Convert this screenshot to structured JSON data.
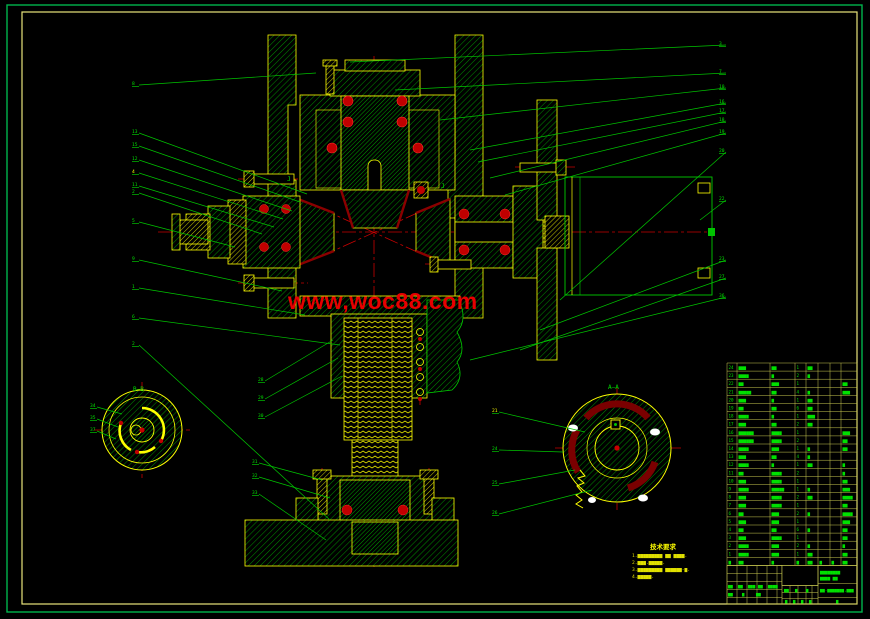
{
  "watermark": {
    "text": "www,woc88.com",
    "color": "#e60000"
  },
  "section_labels": {
    "left_circle": "B—B",
    "right_circle": "A—A",
    "detail_j1": "J",
    "detail_j2": "J"
  },
  "leaders": {
    "left": [
      "8",
      "13",
      "15",
      "12",
      "4",
      "11",
      "2",
      "5",
      "9",
      "1",
      "6",
      "2"
    ],
    "right": [
      "3",
      "7",
      "10",
      "16",
      "17",
      "18",
      "19",
      "20",
      "22",
      "23",
      "27",
      "36"
    ],
    "worm": [
      "28",
      "29",
      "30"
    ],
    "mid": [
      "31",
      "32",
      "33"
    ],
    "circle_left": [
      "34",
      "35",
      "37"
    ],
    "circle_right": [
      "21",
      "24",
      "25",
      "26"
    ]
  },
  "notes": {
    "title": "技术要求",
    "lines": [
      "1.▆▆▆▆▆▆▆▆▆ ▆▆ ▆▆▆▆.",
      "2.▆▆▆.▆▆▆▆▆.",
      "3.▆▆▆▆▆▆▆▆▆ ▆▆▆▆▆▆-▆.",
      "4.▆▆▆▆▆."
    ]
  },
  "parts_table": {
    "rows": [
      [
        "24",
        "▆▆▆",
        "▆▆",
        "1",
        "▆▆",
        "",
        "",
        ""
      ],
      [
        "23",
        "▆▆▆▆",
        "▆",
        "2",
        "▆",
        "",
        "",
        ""
      ],
      [
        "22",
        "▆▆",
        "▆▆▆",
        "1",
        "",
        "",
        "",
        "▆▆"
      ],
      [
        "21",
        "▆▆▆▆▆",
        "▆▆",
        "4",
        "▆",
        "",
        "",
        "▆▆▆"
      ],
      [
        "20",
        "▆▆▆",
        "▆",
        "1",
        "▆▆",
        "",
        "",
        ""
      ],
      [
        "19",
        "▆▆",
        "▆▆",
        "6",
        "▆▆",
        "",
        "",
        ""
      ],
      [
        "18",
        "▆▆▆▆",
        "▆",
        "1",
        "▆▆▆",
        "",
        "",
        ""
      ],
      [
        "17",
        "▆▆▆",
        "▆▆",
        "2",
        "▆▆",
        "",
        "",
        ""
      ],
      [
        "16",
        "▆▆▆▆▆▆",
        "▆▆▆▆",
        "1",
        "",
        "",
        "",
        "▆▆▆"
      ],
      [
        "15",
        "▆▆▆▆▆▆",
        "▆▆▆▆",
        "2",
        "",
        "",
        "",
        "▆▆"
      ],
      [
        "14",
        "▆▆▆▆",
        "▆▆▆",
        "1",
        "▆",
        "",
        "",
        "▆▆"
      ],
      [
        "13",
        "▆▆▆",
        "▆▆",
        "4",
        "▆",
        "",
        "",
        ""
      ],
      [
        "12",
        "▆▆▆▆",
        "▆",
        "1",
        "▆▆",
        "",
        "",
        "▆"
      ],
      [
        "11",
        "▆▆",
        "▆▆▆▆",
        "2",
        "",
        "",
        "",
        "▆"
      ],
      [
        "10",
        "▆▆▆",
        "▆▆▆▆",
        "1",
        "",
        "",
        "",
        "▆▆"
      ],
      [
        "9",
        "▆▆▆▆",
        "▆▆▆▆▆",
        "1",
        "▆",
        "",
        "",
        "▆▆▆"
      ],
      [
        "8",
        "▆▆▆",
        "▆▆▆▆",
        "2",
        "▆▆",
        "",
        "",
        "▆▆▆▆"
      ],
      [
        "7",
        "▆▆▆",
        "▆▆▆▆",
        "1",
        "",
        "",
        "",
        "▆▆"
      ],
      [
        "6",
        "▆▆",
        "▆▆▆",
        "2",
        "▆",
        "",
        "",
        "▆▆▆▆"
      ],
      [
        "5",
        "▆▆▆",
        "▆▆▆",
        "1",
        "",
        "",
        "",
        "▆▆▆"
      ],
      [
        "4",
        "▆▆",
        "▆▆",
        "6",
        "▆",
        "",
        "",
        "▆▆"
      ],
      [
        "3",
        "▆▆▆",
        "▆▆▆▆",
        "1",
        "",
        "",
        "",
        "▆▆"
      ],
      [
        "2",
        "▆▆▆▆",
        "▆▆▆",
        "2",
        "▆",
        "",
        "",
        "▆"
      ],
      [
        "1",
        "▆▆▆▆",
        "▆▆▆",
        "1",
        "▆▆",
        "",
        "",
        "▆▆"
      ]
    ],
    "header": [
      "▆",
      "▆▆",
      "▆",
      "▆",
      "▆▆",
      "▆",
      "▆",
      "▆▆"
    ]
  },
  "title_block": {
    "left_row1": [
      "▆▆",
      "▆▆",
      "▆▆▆",
      "▆▆",
      "▆▆▆▆"
    ],
    "left_row2": [
      "▆▆",
      "▆",
      "▆▆"
    ],
    "mid_row": [
      "▆▆",
      "▆",
      "▆"
    ],
    "mid_bottom": [
      "▆",
      "▆",
      "▆",
      "▆"
    ],
    "right_top1": "▆▆▆▆▆▆▆▆",
    "right_top2": "▆▆▆▆ ▆▆",
    "right_mid": "▆▆-▆▆▆▆▆▆▆,▆▆▆",
    "right_bottom": "▆"
  }
}
